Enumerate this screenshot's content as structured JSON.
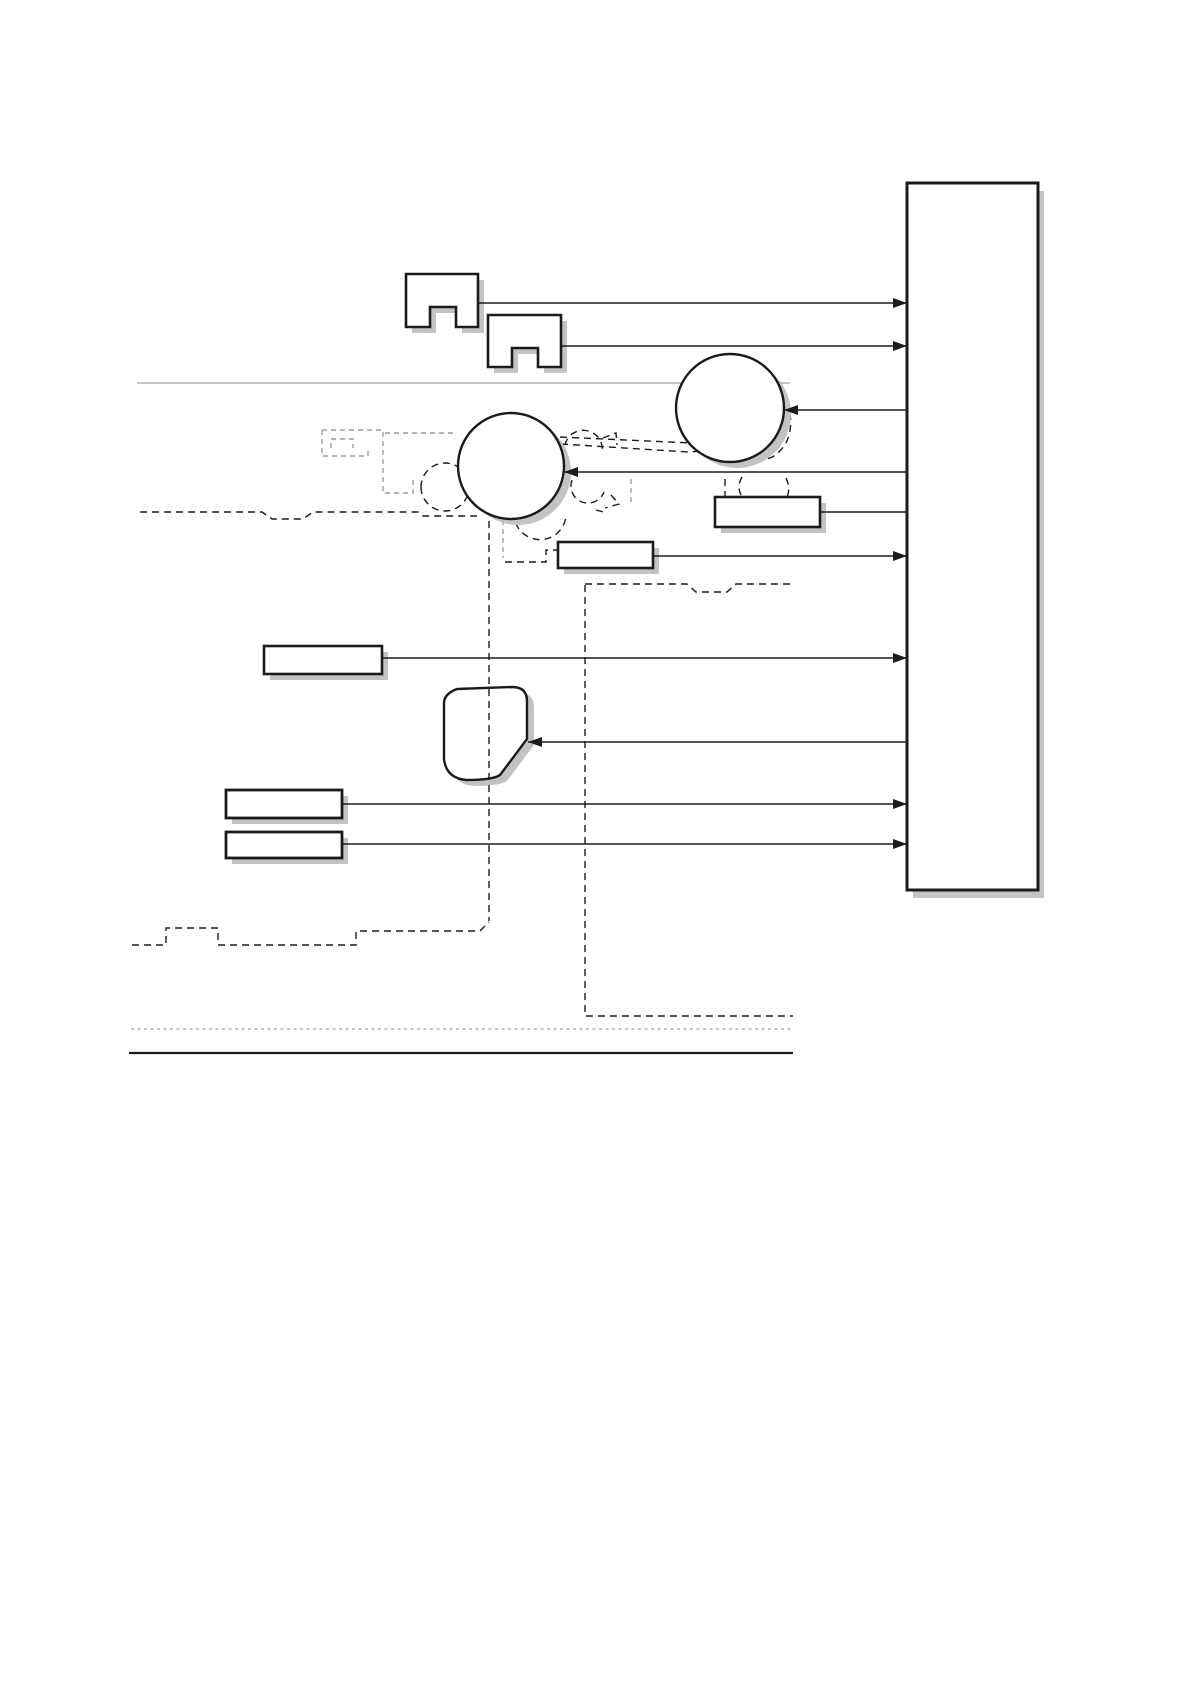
{
  "page": {
    "width": 1192,
    "height": 1682,
    "background": "#ffffff"
  },
  "colors": {
    "stroke": "#1b1b1b",
    "shadow": "#c3c3c3",
    "gray_line": "#b0b0b0",
    "gray_dash": "#9e9e9e",
    "fill": "#ffffff"
  },
  "diagram": {
    "nodes": [
      {
        "name": "controller-board-box",
        "type": "rect",
        "x": 907,
        "y": 183,
        "w": 131,
        "h": 707,
        "sw": 3,
        "sdx": 6,
        "sdy": 8
      },
      {
        "name": "motor-icon-1",
        "type": "path",
        "d": "M406,274 H478 V327 H456 V307 H430 V327 H406 Z",
        "sw": 2.6,
        "sdx": 6,
        "sdy": 6
      },
      {
        "name": "motor-icon-2",
        "type": "path",
        "d": "M488,315 H561 V367 H538 V348 H512 V367 H488 Z",
        "sw": 2.6,
        "sdx": 6,
        "sdy": 6
      },
      {
        "name": "roller-circle-right",
        "type": "circle",
        "cx": 730,
        "cy": 408,
        "r": 54,
        "sw": 2.4,
        "sdx": 7,
        "sdy": 6
      },
      {
        "name": "roller-circle-left",
        "type": "circle",
        "cx": 511,
        "cy": 466,
        "r": 53,
        "sw": 2.4,
        "sdx": 7,
        "sdy": 6
      },
      {
        "name": "component-box-a",
        "type": "rect",
        "x": 715,
        "y": 497,
        "w": 105,
        "h": 30,
        "sw": 2.6,
        "sdx": 6,
        "sdy": 6
      },
      {
        "name": "component-box-b",
        "type": "rect",
        "x": 558,
        "y": 542,
        "w": 95,
        "h": 26,
        "sw": 2.6,
        "sdx": 6,
        "sdy": 6
      },
      {
        "name": "component-box-c",
        "type": "rect",
        "x": 264,
        "y": 646,
        "w": 118,
        "h": 28,
        "sw": 2.6,
        "sdx": 6,
        "sdy": 6
      },
      {
        "name": "hopper-shape",
        "type": "path",
        "d": "M457,689 L512,687 Q527,687 527,701 L527,739 L500,775 Q493,780 466,780 Q446,778 444,759 L444,703 Q444,694 457,689 Z",
        "sw": 2.4,
        "sdx": 7,
        "sdy": 6
      },
      {
        "name": "component-box-d",
        "type": "rect",
        "x": 226,
        "y": 790,
        "w": 116,
        "h": 28,
        "sw": 2.8,
        "sdx": 6,
        "sdy": 6
      },
      {
        "name": "component-box-e",
        "type": "rect",
        "x": 226,
        "y": 832,
        "w": 116,
        "h": 26,
        "sw": 2.8,
        "sdx": 6,
        "sdy": 6
      }
    ],
    "connectors": [
      {
        "name": "link-motor1-to-board",
        "x1": 478,
        "x2": 907,
        "y": 303,
        "arrow": "end"
      },
      {
        "name": "link-motor2-to-board",
        "x1": 561,
        "x2": 907,
        "y": 346,
        "arrow": "end"
      },
      {
        "name": "link-board-to-roller-r",
        "x1": 784,
        "x2": 907,
        "y": 410,
        "arrow": "start"
      },
      {
        "name": "link-board-to-roller-l",
        "x1": 564,
        "x2": 907,
        "y": 472,
        "arrow": "start"
      },
      {
        "name": "link-box-a-to-board",
        "x1": 820,
        "x2": 907,
        "y": 512,
        "arrow": "none"
      },
      {
        "name": "link-box-b-to-board",
        "x1": 653,
        "x2": 907,
        "y": 556,
        "arrow": "end"
      },
      {
        "name": "link-box-c-to-board",
        "x1": 382,
        "x2": 907,
        "y": 658,
        "arrow": "end"
      },
      {
        "name": "link-board-to-hopper",
        "x1": 528,
        "x2": 907,
        "y": 742,
        "arrow": "start"
      },
      {
        "name": "link-box-d-to-board",
        "x1": 342,
        "x2": 907,
        "y": 804,
        "arrow": "end"
      },
      {
        "name": "link-box-e-to-board",
        "x1": 342,
        "x2": 907,
        "y": 844,
        "arrow": "end"
      }
    ],
    "solid_lines": [
      {
        "name": "platen-rule-top",
        "x1": 137,
        "x2": 790,
        "y": 383,
        "color": "gray_line",
        "w": 1.6
      },
      {
        "name": "base-rule-bottom",
        "x1": 129,
        "x2": 793,
        "y": 1053,
        "color": "stroke",
        "w": 2.2
      }
    ],
    "dashed_black": [
      {
        "name": "paper-path-left",
        "d": "M140,512 H262 L272,519 H303 L313,512 H418 L423,516 H477"
      },
      {
        "name": "paper-path-right",
        "d": "M585,584 H687 L696,592 H727 L736,584 H791"
      },
      {
        "name": "laser-wedge-top",
        "d": "M560,437 L757,446"
      },
      {
        "name": "laser-wedge-bottom",
        "d": "M561,444 L688,452 L757,448"
      },
      {
        "name": "wedge-flag",
        "d": "M603,438 L616,433 L617,445"
      },
      {
        "name": "nip-arc-top-right",
        "d": "M566,457 A19,19 0 1 1 602,453"
      },
      {
        "name": "nip-arc-right",
        "d": "M572,480 A17,17 0 0 0 604,492"
      },
      {
        "name": "nip-bracket",
        "d": "M611,495 L619,504 L605,508 M596,510 L607,513"
      },
      {
        "name": "nip-arc-bottom",
        "d": "M514,511 A26,26 0 0 0 566,516"
      },
      {
        "name": "connector-step",
        "d": "M505,562 H546 V550 H557"
      },
      {
        "name": "fuser-roller-dashes",
        "d": "M725,479 V497 M742,477 Q736,487 742,497 M786,478 Q791,488 787,497"
      },
      {
        "name": "drum-nip-arc",
        "d": "M790,413 Q794,442 774,456 Q764,462 750,460"
      },
      {
        "name": "pickup-roller-circle",
        "d": "M421,487 a24,24 0 1 0 48,0 a24,24 0 1 0 -48,0"
      },
      {
        "name": "tray-outline",
        "d": "M132,945 H166 V928 H218 V945 H356 V931 H480 L489,922"
      }
    ],
    "dashed_gray": [
      {
        "name": "reg-assembly-top",
        "d": "M322,430 H383"
      },
      {
        "name": "reg-assembly-body",
        "d": "M322,430 V456 H368 V448"
      },
      {
        "name": "reg-assembly-notch",
        "d": "M331,448 V439 H353 V448"
      },
      {
        "name": "reg-assembly-right",
        "d": "M383,432 V493 H413 V479"
      },
      {
        "name": "reg-feed-line",
        "d": "M385,433 H457"
      },
      {
        "name": "gray-guide-short-1",
        "d": "M503,520 V558"
      },
      {
        "name": "gray-guide-short-2",
        "d": "M631,479 V502"
      },
      {
        "name": "bottom-gray-rule",
        "d": "M131,1029 H791",
        "dash": "3 3.5",
        "w": 1.2
      }
    ],
    "overlay_dashed": [
      {
        "name": "guide-vertical-1",
        "d": "M489,521 V921"
      },
      {
        "name": "guide-vertical-2",
        "d": "M585,585 V1016 H793"
      }
    ],
    "arrow": {
      "length": 14,
      "half_width": 5
    }
  }
}
